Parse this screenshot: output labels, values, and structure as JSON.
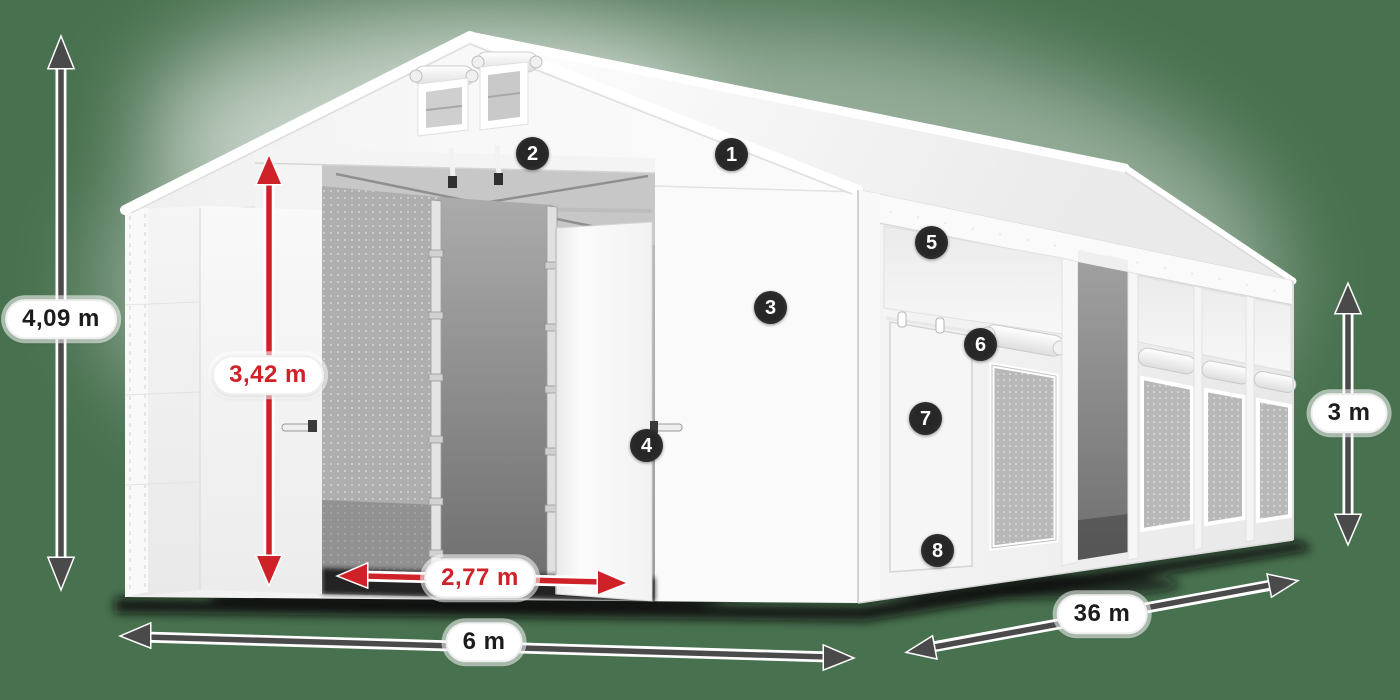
{
  "colors": {
    "background": "#48714f",
    "dimension_red": "#cf2128",
    "dimension_dark": "#4a4a4a",
    "dimension_label_text": "#1c1c1c",
    "marker_background": "#272727",
    "marker_number": "#ffffff",
    "tent_white": "#f7f7f7"
  },
  "dimensions": {
    "total_height": "4,09 m",
    "interior_height": "3,42 m",
    "entrance_width": "2,77 m",
    "tent_width": "6 m",
    "tent_length": "36 m",
    "side_wall_height": "3 m"
  },
  "markers": [
    {
      "number": "1"
    },
    {
      "number": "2"
    },
    {
      "number": "3"
    },
    {
      "number": "4"
    },
    {
      "number": "5"
    },
    {
      "number": "6"
    },
    {
      "number": "7"
    },
    {
      "number": "8"
    }
  ]
}
